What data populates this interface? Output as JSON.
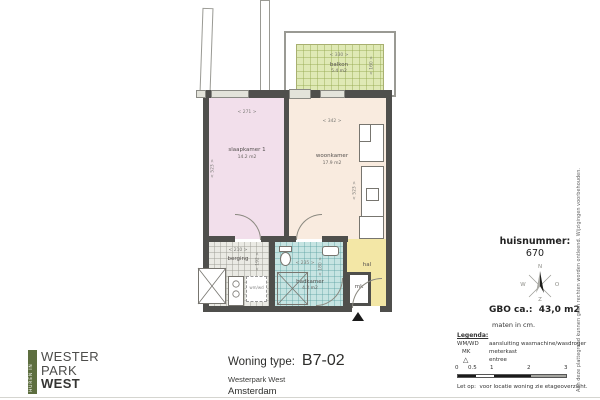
{
  "plan": {
    "rooms": {
      "balkon": {
        "name": "balkon",
        "area": "5.4 m2",
        "dim_w": "< 330 >",
        "dim_h": "< 160 >"
      },
      "slaapkamer": {
        "name": "slaapkamer 1",
        "area": "14.2 m2",
        "dim_w": "< 271 >",
        "dim_h": "< 523 >"
      },
      "woonkamer": {
        "name": "woonkamer",
        "area": "17.9 m2",
        "dim_w": "< 342 >",
        "dim_h": "< 523 >"
      },
      "berging": {
        "name": "berging",
        "dim_w": "< 210 >",
        "dim_h": "< 192 >"
      },
      "badkamer": {
        "name": "badkamer",
        "area": "4.2 m2",
        "dim_w": "< 235 >",
        "dim_h": "< 180 >"
      },
      "mk": {
        "name": "mk"
      },
      "hal": {
        "name": "hal"
      },
      "wmwd_label": "wm/wd"
    }
  },
  "info": {
    "huisnummer_label": "huisnummer:",
    "huisnummer_value": "670",
    "gbo": "GBO ca.:  43,0 m2",
    "maten": "maten in cm.",
    "compass": {
      "n": "N",
      "o": "O",
      "w": "W",
      "z": "Z"
    }
  },
  "legend": {
    "title": "Legenda:",
    "items": [
      {
        "key": "WM/WD",
        "value": "aansluiting wasmachine/wasdroger"
      },
      {
        "key": "MK",
        "value": "meterkast"
      },
      {
        "key": "△",
        "value": "entree"
      }
    ],
    "scale_ticks": [
      "0",
      "0.5",
      "1",
      "2",
      "3"
    ],
    "note": "Let op:  voor locatie woning zie etageoverzicht."
  },
  "title_block": {
    "label": "Woning type:",
    "code": "B7-02",
    "project": "Westerpark West",
    "city": "Amsterdam"
  },
  "logo": {
    "strip": "HUREN IN",
    "line1": "WESTER",
    "line2": "PARK",
    "line3": "WEST"
  },
  "disclaimer": "Aan deze plattegrond kunnen geen rechten worden ontleend. Wijzigingen voorbehouden.",
  "colors": {
    "wall": "#4f4f4c",
    "balkon": "#dfe9b5",
    "slaapkamer": "#f2dfeb",
    "woonkamer": "#f9ebdf",
    "badkamer": "#c6e4e2",
    "hal": "#f3e7a6",
    "berging": "#eaeae4",
    "logo_strip": "#5d6e3f"
  }
}
